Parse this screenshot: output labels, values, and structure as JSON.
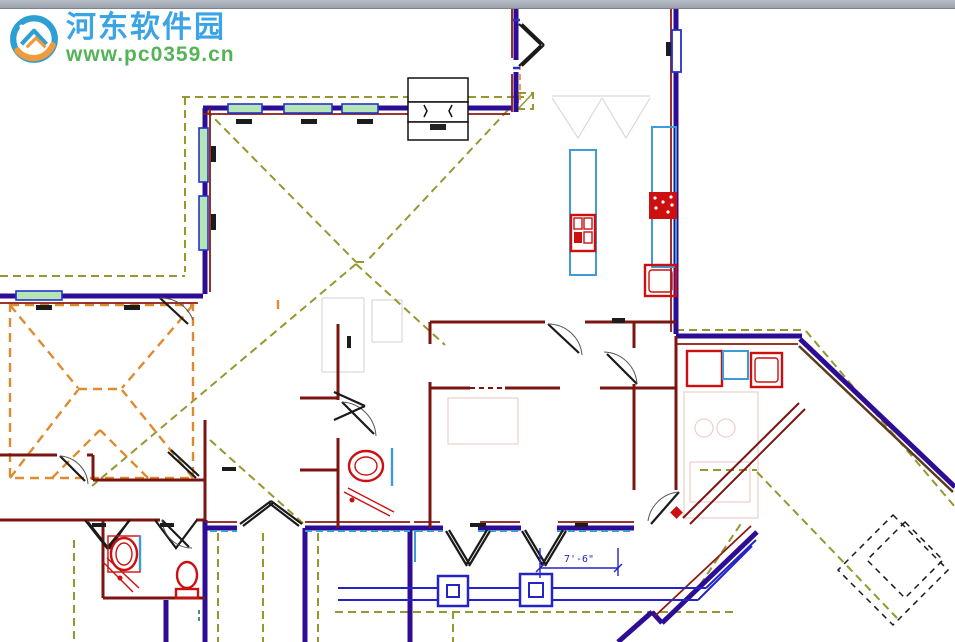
{
  "window": {
    "description": "cropped application window top edge"
  },
  "watermark": {
    "site_name": "河东软件园",
    "site_url": "www.pc0359.cn"
  },
  "drawing": {
    "type": "architectural-floor-plan",
    "dimension_label": "7'-6\"",
    "elements": [
      "exterior-walls",
      "interior-walls",
      "windows",
      "doors",
      "entry-double-door",
      "french-doors",
      "roof-overhang-olive",
      "roof-overhang-orange",
      "hip-roof-lines",
      "fireplace",
      "kitchen-island",
      "range",
      "cooktop",
      "dishwasher",
      "kitchen-counter",
      "washer",
      "dryer",
      "laundry-sink",
      "bathroom-sink",
      "toilet",
      "vanity-counter",
      "porch-columns",
      "porch-floor-edge",
      "dimension-line",
      "garage-ceiling-dashed",
      "window-size-labels"
    ]
  },
  "palette": {
    "bg": "#ffffff",
    "topbar-a": "#b8bec8",
    "topbar-b": "#99a0aa",
    "wall-ext": "#2e0d96",
    "wall-acc": "#8c1a10",
    "wall-int": "#7a1510",
    "wall-brown": "#5a3a1a",
    "fix-red": "#cc1010",
    "counter-blue": "#3d9bd5",
    "frame-blue": "#2233cc",
    "glass-green": "#b5e4b5",
    "dash-olive": "#97972f",
    "dash-orange": "#e08a2e",
    "dash-green": "#3a8a3a",
    "door-black": "#1a1a1a",
    "arc-gray": "#555555",
    "faint-gray": "#d9d9d9",
    "faint-pink": "#eccfc9",
    "porch-blue": "#2323c8",
    "label-dark": "#1c1c1c",
    "wm-blue": "#3aa4e6",
    "wm-green": "#55b357",
    "wm-logo-blue": "#2e9fd4",
    "wm-logo-orange": "#f09a3c"
  }
}
